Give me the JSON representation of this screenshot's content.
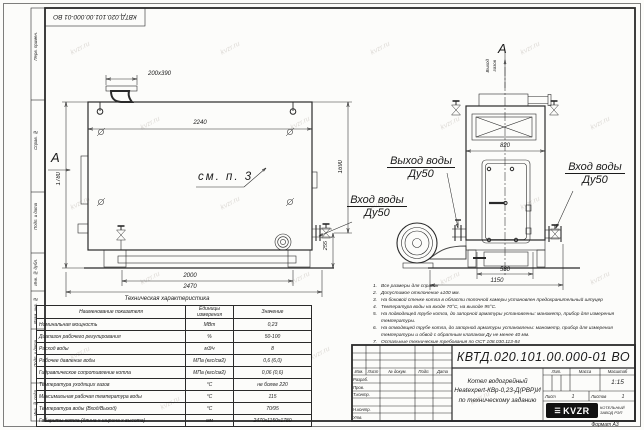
{
  "watermark": {
    "text": "kvzr.ru"
  },
  "stamp_top": {
    "code": "КВТД.020.101.00.000-01 ВО"
  },
  "margin_column": {
    "labels": [
      "Перв. примен.",
      "Справ. №",
      "Подп. и дата",
      "Инв. № дубл.",
      "Взам. инв. №",
      "Подп. и дата",
      "Инв. № подл."
    ]
  },
  "views": {
    "arrow_label_main": "А",
    "arrow_label_side": "А",
    "gas_outlet_line1": "Выход",
    "gas_outlet_line2": "газов",
    "see_note": "см. п. 3",
    "water_outlet_title": "Выход воды",
    "water_outlet_dn": "Ду50",
    "water_inlet_main_title": "Вход воды",
    "water_inlet_main_dn": "Ду50",
    "water_inlet_side_title": "Вход воды",
    "water_inlet_side_dn": "Ду50"
  },
  "dims": {
    "flue": "200х390",
    "top_width": "2240",
    "height_left": "1780",
    "height_right": "1690",
    "pipe": "255",
    "base_inner": "2000",
    "base_outer": "2470",
    "side_width": "820",
    "side_base_inner": "580",
    "side_base_outer": "1150"
  },
  "notes": {
    "items": [
      {
        "n": "1.",
        "text": "Все размеры для справок"
      },
      {
        "n": "2.",
        "text": "Допустимое отклонение ±100 мм."
      },
      {
        "n": "3.",
        "text": "На боковой стенке котла в области топочной камеры установлен предохранительный штуцер"
      },
      {
        "n": "4.",
        "text": "Температура воды на входе 70°С, на выходе 95°С."
      },
      {
        "n": "5.",
        "text": "На подводящей трубе котла, до запорной арматуры установлены: манометр, прибор для измерения температуры."
      },
      {
        "n": "6.",
        "text": "На отводящей трубе котла, до запорной арматуры установлены: манометр, прибор для измерения температуры и обвод с обратным клапаном Ду не менее 40 мм."
      },
      {
        "n": "7.",
        "text": "Остальные технические требования по ОСТ 108.030.113-84"
      }
    ]
  },
  "tech_table": {
    "title": "Техническая характеристика",
    "headers": [
      "Наименование показателя",
      "Единицы измерения",
      "Значение"
    ],
    "rows": [
      [
        "Номинальная мощность",
        "МВт",
        "0,23"
      ],
      [
        "Диапазон рабочего регулирования",
        "%",
        "50-100"
      ],
      [
        "Расход воды",
        "м3/ч",
        "8"
      ],
      [
        "Рабочее давление воды",
        "МПа (кгс/см2)",
        "0,6 (6,0)"
      ],
      [
        "Гидравлическое сопротивление котла",
        "МПа (кгс/см2)",
        "0,06 (0,6)"
      ],
      [
        "Температура уходящих газов",
        "°С",
        "не более 220"
      ],
      [
        "Максимальная рабочая температура воды",
        "°С",
        "115"
      ],
      [
        "Температура воды (Вход/Выход)",
        "°С",
        "70/95"
      ],
      [
        "Габариты котла (длина х ширина х высота)",
        "мм",
        "2470х1150х1780"
      ]
    ]
  },
  "title_block": {
    "designation": "КВТД.020.101.00.000-01 ВО",
    "name_line1": "Котел водогрейный",
    "name_line2": "Heatexpert-КВр-0,23-Д(РВР)И",
    "name_line3": "по техническому заданию",
    "col_izm": "Изм.",
    "col_list": "Лист",
    "col_doc": "№ докум.",
    "col_sign": "Подп.",
    "col_date": "Дата",
    "row_dev": "Разраб.",
    "row_check": "Пров.",
    "row_tcontr": "Т.контр.",
    "row_ncontr": "Н.контр.",
    "row_approve": "Утв.",
    "lit": "Лит.",
    "mass": "Масса",
    "scale": "Масштаб",
    "scale_value": "1:15",
    "sheet_label": "Лист",
    "sheet_value": "1",
    "sheets_label": "Листов",
    "sheets_value": "1",
    "logo_text": "KVZR",
    "logo_sub1": "КОТЕЛЬНЫЙ",
    "logo_sub2": "ЗАВОД РЭП",
    "format": "Формат А3"
  }
}
